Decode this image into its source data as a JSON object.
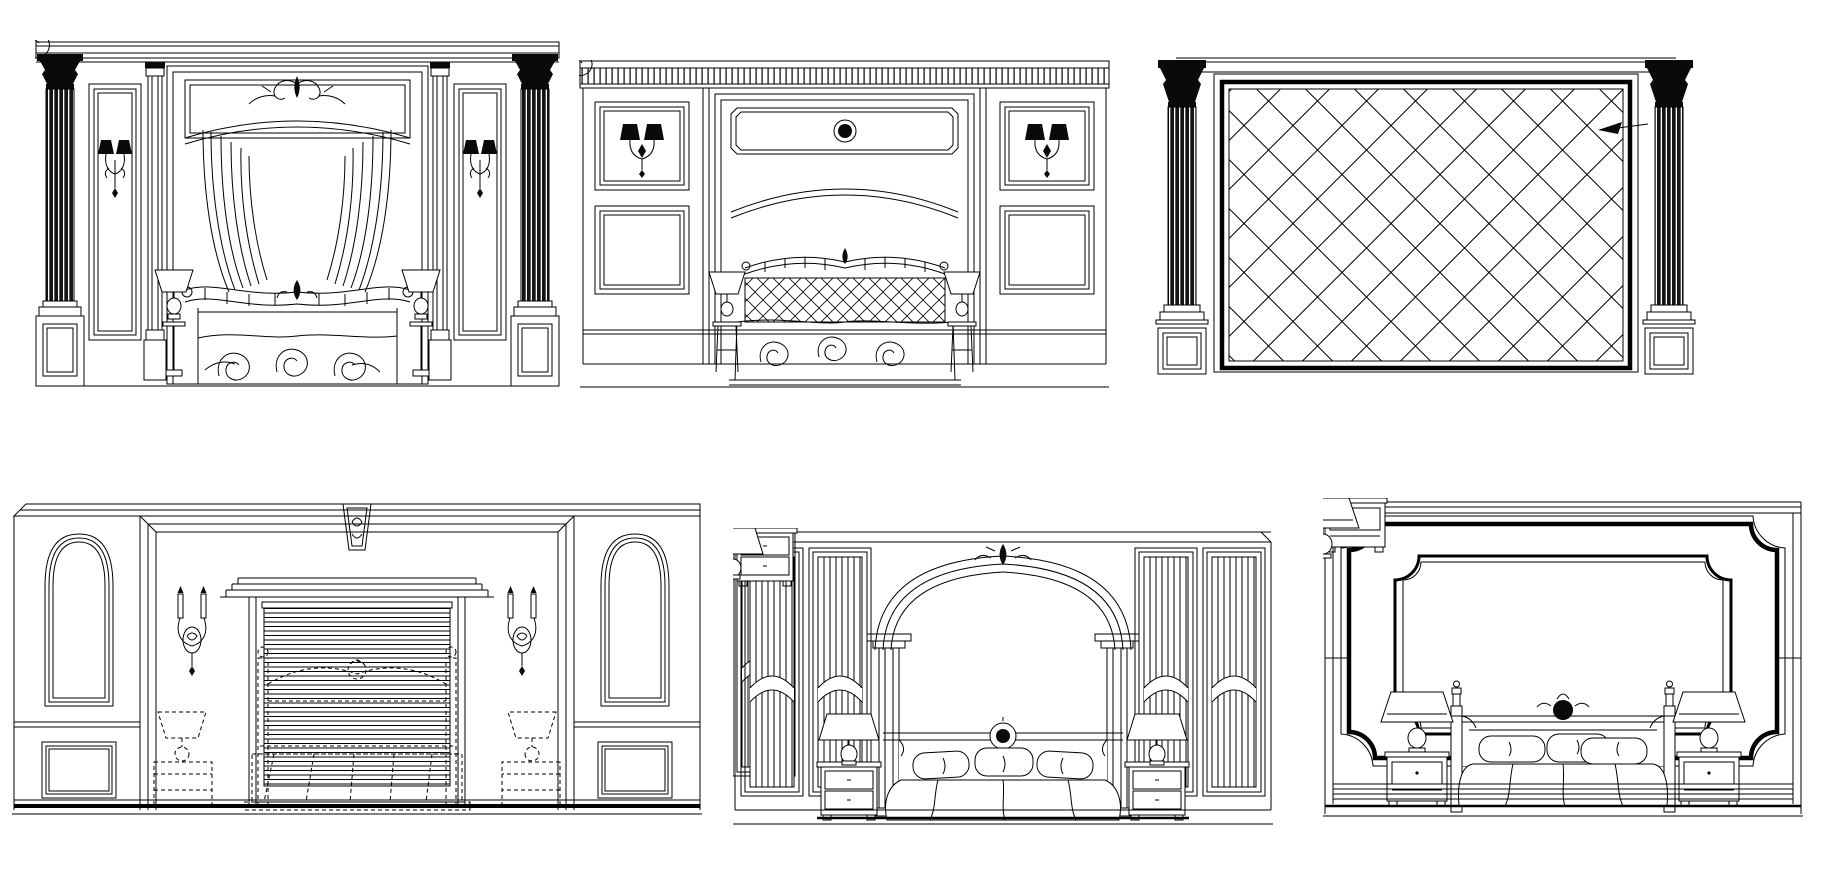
{
  "page": {
    "title": "Bedroom Design Elevation CAD Blocks",
    "background_color": "#ffffff",
    "line_color": "#000000",
    "dark_fill_color": "#0a0a0a",
    "canvas": {
      "width": 1847,
      "height": 884
    }
  },
  "drawings": [
    {
      "id": "canopy-bed-elevation",
      "label": "Bedroom wall elevation: Corinthian columns, sconce panels, arched curtain canopy bed with ornate valance and swirl bedspread",
      "row": "top",
      "features": [
        "corinthian-column",
        "wall-sconce",
        "crest-ornament",
        "curtain-canopy",
        "valance-rail",
        "swirl-bedspread",
        "table-lamp",
        "pedestal-base"
      ]
    },
    {
      "id": "paneled-wall-bed-elevation",
      "label": "Bedroom wall elevation: fluted frieze, double wall panels with sconces, arched header with rosette, lattice headboard bed",
      "row": "top",
      "features": [
        "fluted-frieze",
        "wall-panel",
        "double-sconce",
        "rosette-header",
        "crest-rail",
        "lattice-headboard",
        "swirl-bedspread",
        "candle-stand-lamp"
      ]
    },
    {
      "id": "tufted-wall-elevation",
      "label": "Wall elevation: diamond lattice tufted panel framed by Corinthian columns on pedestals, with leader arrow annotation",
      "row": "top",
      "features": [
        "corinthian-column",
        "diamond-lattice-panel",
        "leader-arrow",
        "pedestal-base"
      ]
    },
    {
      "id": "window-blinds-bed-elevation",
      "label": "Bedroom alcove elevation: keystone surround, candle sconces, venetian blind window, dashed hidden bed and lamps, wainscot panels",
      "row": "bottom",
      "features": [
        "keystone",
        "arched-side-panel",
        "candle-sconce",
        "window-pediment",
        "venetian-blinds",
        "dashed-bed",
        "dashed-lamp",
        "wainscot-panel"
      ]
    },
    {
      "id": "arched-alcove-bed-elevation",
      "label": "Bedroom elevation: central arch with crest on fluted columns, fluted side panels, canopy rail with medallion, bed with nightstands and lamps",
      "row": "bottom",
      "features": [
        "center-arch",
        "crest-ornament",
        "fluted-column",
        "fluted-panel",
        "canopy-rail-medallion",
        "pillows",
        "draped-duvet",
        "nightstand",
        "table-lamp"
      ]
    },
    {
      "id": "molded-frame-bed-elevation",
      "label": "Bedroom elevation: double molded frame with concave corners, four-poster bed with headboard crest, nightstands with lamps, striped baseboard",
      "row": "bottom",
      "features": [
        "ogee-corner-frame",
        "bed-post-finial",
        "headboard-crest",
        "pillows",
        "draped-duvet",
        "nightstand",
        "table-lamp",
        "baseboard"
      ]
    }
  ]
}
